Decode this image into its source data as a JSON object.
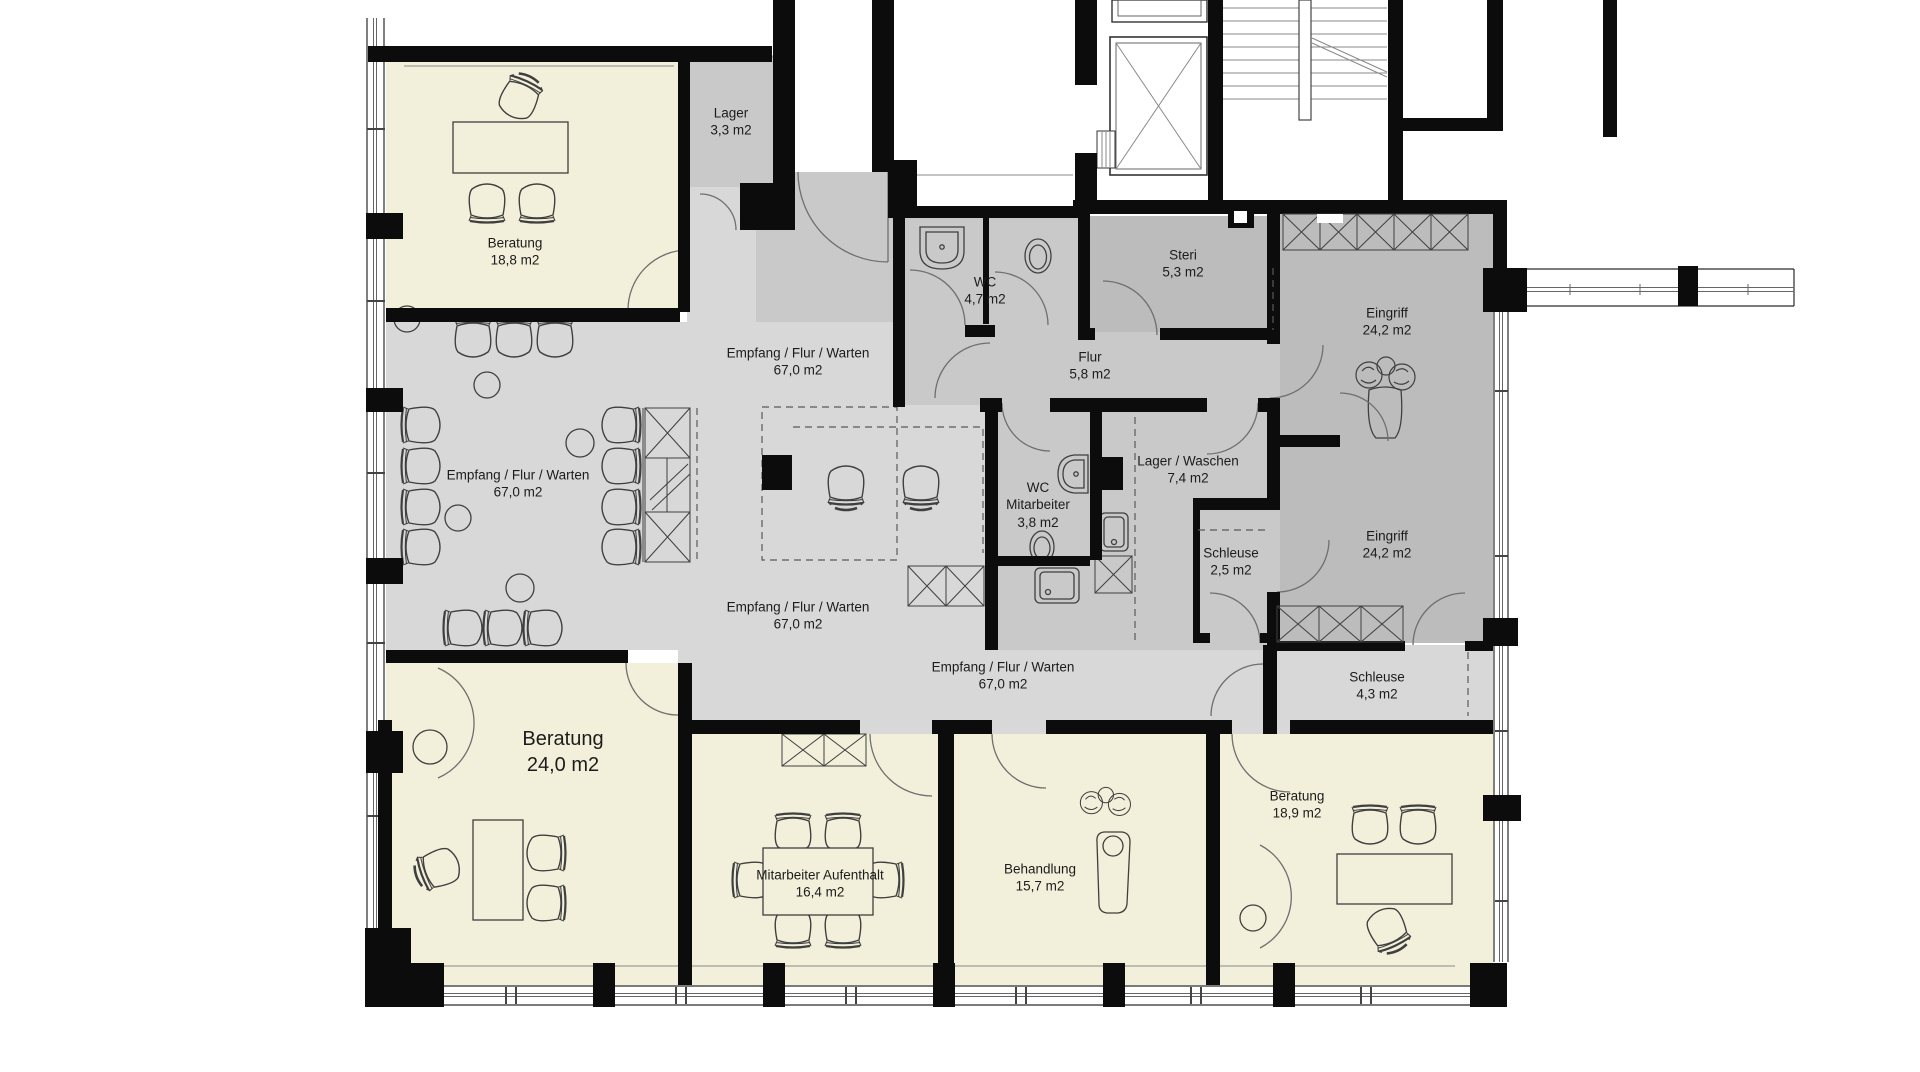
{
  "plan": {
    "colors": {
      "background": "#ffffff",
      "wall": "#0c0c0c",
      "room_cream": "#f2f0da",
      "room_light_gray": "#d8d8d8",
      "room_mid_gray": "#c9c9c9",
      "room_dark_gray": "#bcbcbc"
    },
    "rooms": [
      {
        "id": "beratung-top",
        "name": "Beratung",
        "area": "18,8 m2"
      },
      {
        "id": "lager",
        "name": "Lager",
        "area": "3,3 m2"
      },
      {
        "id": "empfang-top",
        "name": "Empfang / Flur / Warten",
        "area": "67,0 m2"
      },
      {
        "id": "wc",
        "name": "WC",
        "area": "4,7 m2"
      },
      {
        "id": "flur",
        "name": "Flur",
        "area": "5,8 m2"
      },
      {
        "id": "steri",
        "name": "Steri",
        "area": "5,3 m2"
      },
      {
        "id": "eingriff-top",
        "name": "Eingriff",
        "area": "24,2 m2"
      },
      {
        "id": "empfang-left",
        "name": "Empfang / Flur / Warten",
        "area": "67,0 m2"
      },
      {
        "id": "wc-mitarbeiter",
        "name": "WC",
        "name2": "Mitarbeiter",
        "area": "3,8 m2"
      },
      {
        "id": "lager-waschen",
        "name": "Lager / Waschen",
        "area": "7,4 m2"
      },
      {
        "id": "schleuse-klein",
        "name": "Schleuse",
        "area": "2,5 m2"
      },
      {
        "id": "eingriff-bottom",
        "name": "Eingriff",
        "area": "24,2 m2"
      },
      {
        "id": "empfang-center",
        "name": "Empfang / Flur / Warten",
        "area": "67,0 m2"
      },
      {
        "id": "empfang-bottom",
        "name": "Empfang / Flur / Warten",
        "area": "67,0 m2"
      },
      {
        "id": "schleuse-gross",
        "name": "Schleuse",
        "area": "4,3 m2"
      },
      {
        "id": "beratung-gross",
        "name": "Beratung",
        "area": "24,0 m2"
      },
      {
        "id": "mitarbeiter-aufenthalt",
        "name": "Mitarbeiter Aufenthalt",
        "area": "16,4 m2"
      },
      {
        "id": "behandlung",
        "name": "Behandlung",
        "area": "15,7 m2"
      },
      {
        "id": "beratung-rechts",
        "name": "Beratung",
        "area": "18,9 m2"
      }
    ]
  }
}
